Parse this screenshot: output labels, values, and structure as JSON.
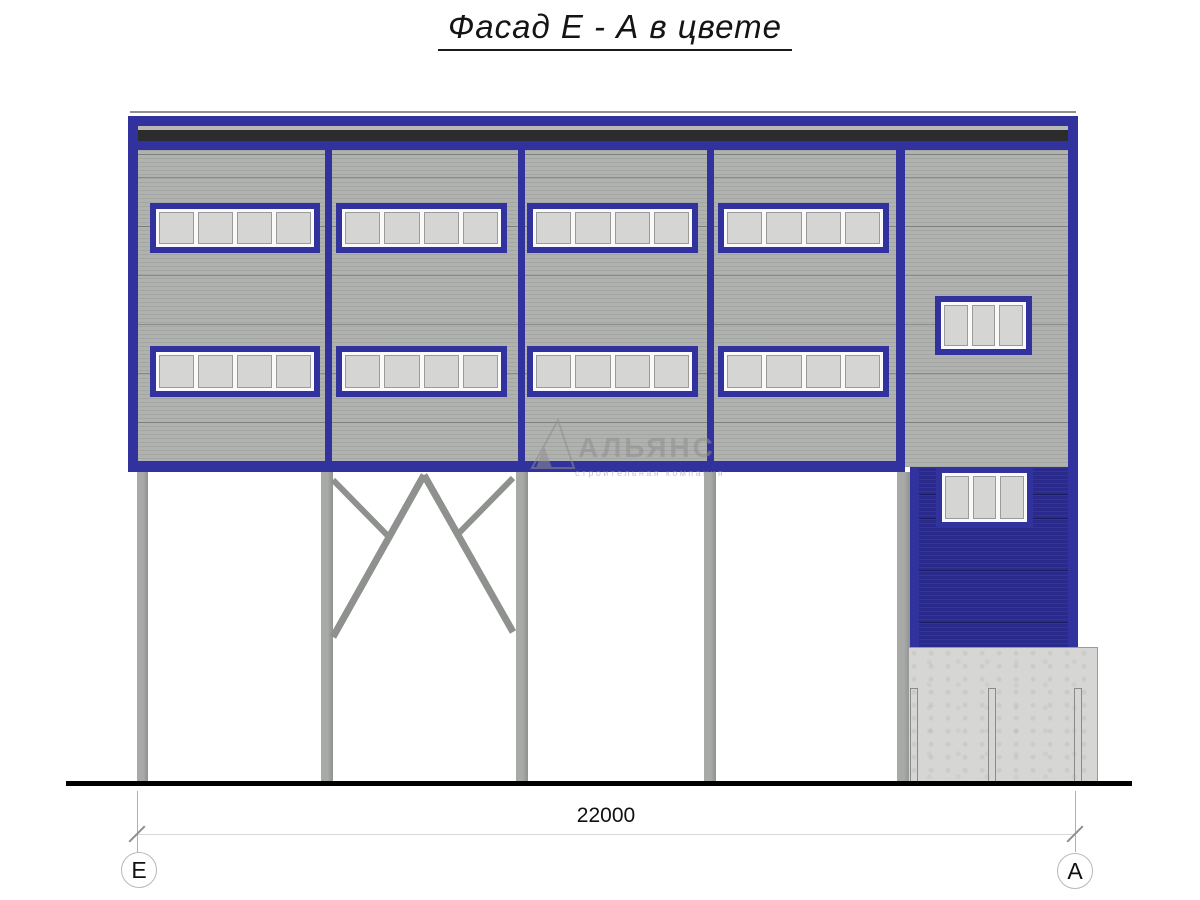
{
  "title": "Фасад Е - А в цвете",
  "watermark": {
    "name": "АЛЬЯНС",
    "subtitle": "строительная компания"
  },
  "dimension": {
    "total": "22000"
  },
  "grid_axes": {
    "left": "Е",
    "right": "А"
  },
  "colors": {
    "frame_blue": "#32329e",
    "panel_blue": "#2a2a8d",
    "siding_gray": "#b0b2af",
    "fascia_dark": "#2c2c2c",
    "fascia_light": "#b8b9b6",
    "glass_gray": "#d5d6d3",
    "column_gray": "#9a9d9a",
    "concrete_gray": "#d6d6d4",
    "ground_black": "#000000",
    "dim_line": "#d8d8d8"
  }
}
